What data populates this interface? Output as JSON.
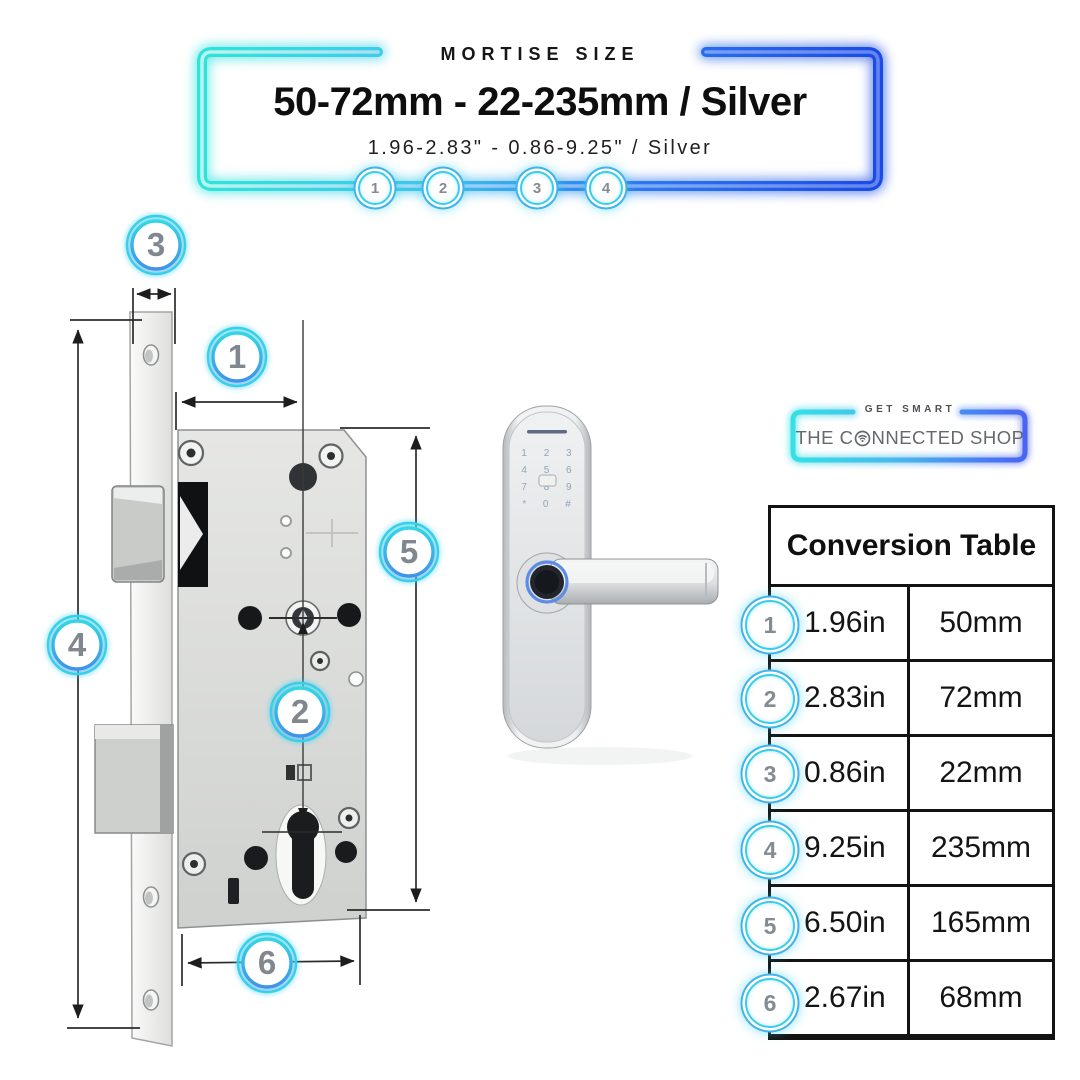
{
  "banner": {
    "eyebrow": "MORTISE SIZE",
    "title": "50-72mm - 22-235mm / Silver",
    "subtitle": "1.96-2.83\" - 0.86-9.25\" / Silver",
    "markers": [
      "1",
      "2",
      "3",
      "4"
    ]
  },
  "brand": {
    "tagline": "GET SMART",
    "name_pre": "THE C",
    "name_post": "NNECTED SHOP"
  },
  "diagram": {
    "callouts": [
      "1",
      "2",
      "3",
      "4",
      "5",
      "6"
    ]
  },
  "device": {
    "keypad_rows": [
      "1 2 3",
      "4 5 6",
      "7 8 9",
      "* 0 #"
    ]
  },
  "table": {
    "title": "Conversion Table",
    "rows": [
      {
        "num": "1",
        "inches": "1.96in",
        "mm": "50mm"
      },
      {
        "num": "2",
        "inches": "2.83in",
        "mm": "72mm"
      },
      {
        "num": "3",
        "inches": "0.86in",
        "mm": "22mm"
      },
      {
        "num": "4",
        "inches": "9.25in",
        "mm": "235mm"
      },
      {
        "num": "5",
        "inches": "6.50in",
        "mm": "165mm"
      },
      {
        "num": "6",
        "inches": "2.67in",
        "mm": "68mm"
      }
    ]
  },
  "colors": {
    "neon_cyan": "#2ee4da",
    "neon_blue": "#1a4be4",
    "badge_number_gray": "#858b93",
    "text_dark": "#0e0e0e",
    "brand_gray": "#66696c",
    "table_border": "#131313"
  }
}
